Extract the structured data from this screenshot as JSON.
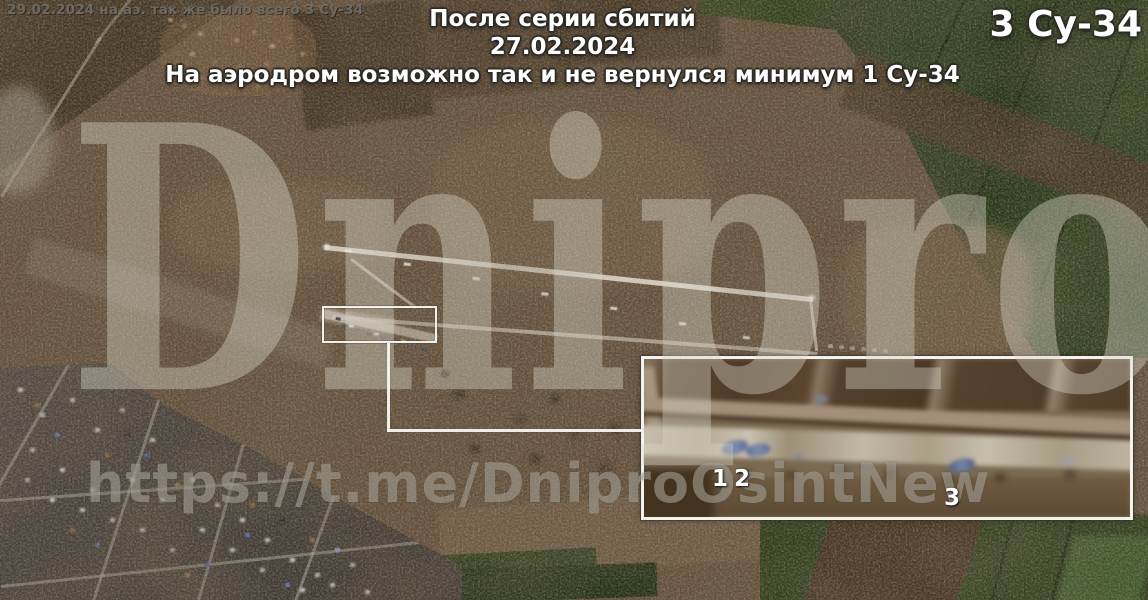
{
  "annotations": {
    "caption_top_left": "29.02.2024 на аэ. так же было всего 3 Су-34",
    "title_line1": "После серии сбитий",
    "title_line2": "27.02.2024",
    "title_line3": "На аэродром возможно так и не вернулся минимум 1 Су-34",
    "corner_count": "3 Су-34"
  },
  "watermarks": {
    "brand": "Dnipro",
    "url": "https://t.me/DniproOsintNew"
  },
  "inset": {
    "aircraft_labels": [
      "1",
      "2",
      "3"
    ]
  },
  "colors": {
    "highlight_border": "#f5f3ee",
    "annotation_text": "#ffffff",
    "caption_gray": "#6e6961",
    "watermark_gray": "#dad4c9",
    "field_brown": "#5f4c38",
    "field_dark_brown": "#3a2c1c",
    "field_green": "#2c3a1b",
    "runway_light": "#e8e2d4",
    "aircraft_blue": "#7e8cab"
  }
}
